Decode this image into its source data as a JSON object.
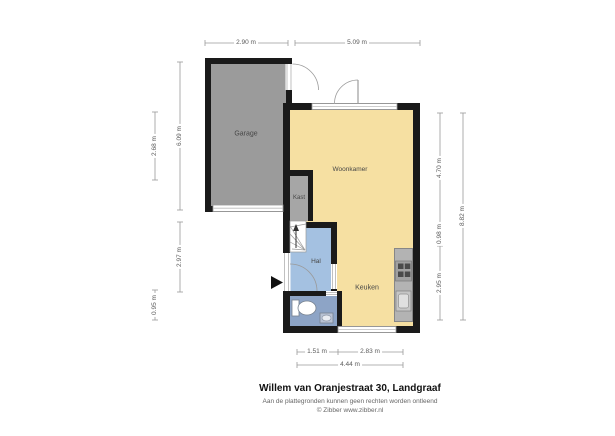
{
  "title": "Willem van Oranjestraat 30, Landgraaf",
  "disclaimer_line1": "Aan de plattegronden kunnen geen rechten worden ontleend",
  "disclaimer_line2": "© Zibber www.zibber.nl",
  "rooms": {
    "garage": "Garage",
    "woonkamer": "Woonkamer",
    "kast": "Kast",
    "hal": "Hal",
    "keuken": "Keuken"
  },
  "dimensions": {
    "top": [
      "2.90 m",
      "5.09 m"
    ],
    "left": [
      "2.68 m",
      "6.09 m",
      "2.97 m",
      "0.95 m"
    ],
    "right_inner": [
      "4.70 m",
      "0.98 m",
      "2.95 m"
    ],
    "right_outer": "8.82 m",
    "bottom_inner": [
      "1.51 m",
      "2.83 m"
    ],
    "bottom_outer": "4.44 m"
  },
  "colors": {
    "wall": "#1a1a1a",
    "garage_fill": "#9b9b9b",
    "living_fill": "#f6e0a2",
    "hall_fill": "#a4c1e1",
    "toilet_fill": "#8da4c6",
    "closet_fill": "#a6a6a6",
    "counter_fill": "#b3b3b3",
    "dimension_line": "#9a9a9a"
  }
}
